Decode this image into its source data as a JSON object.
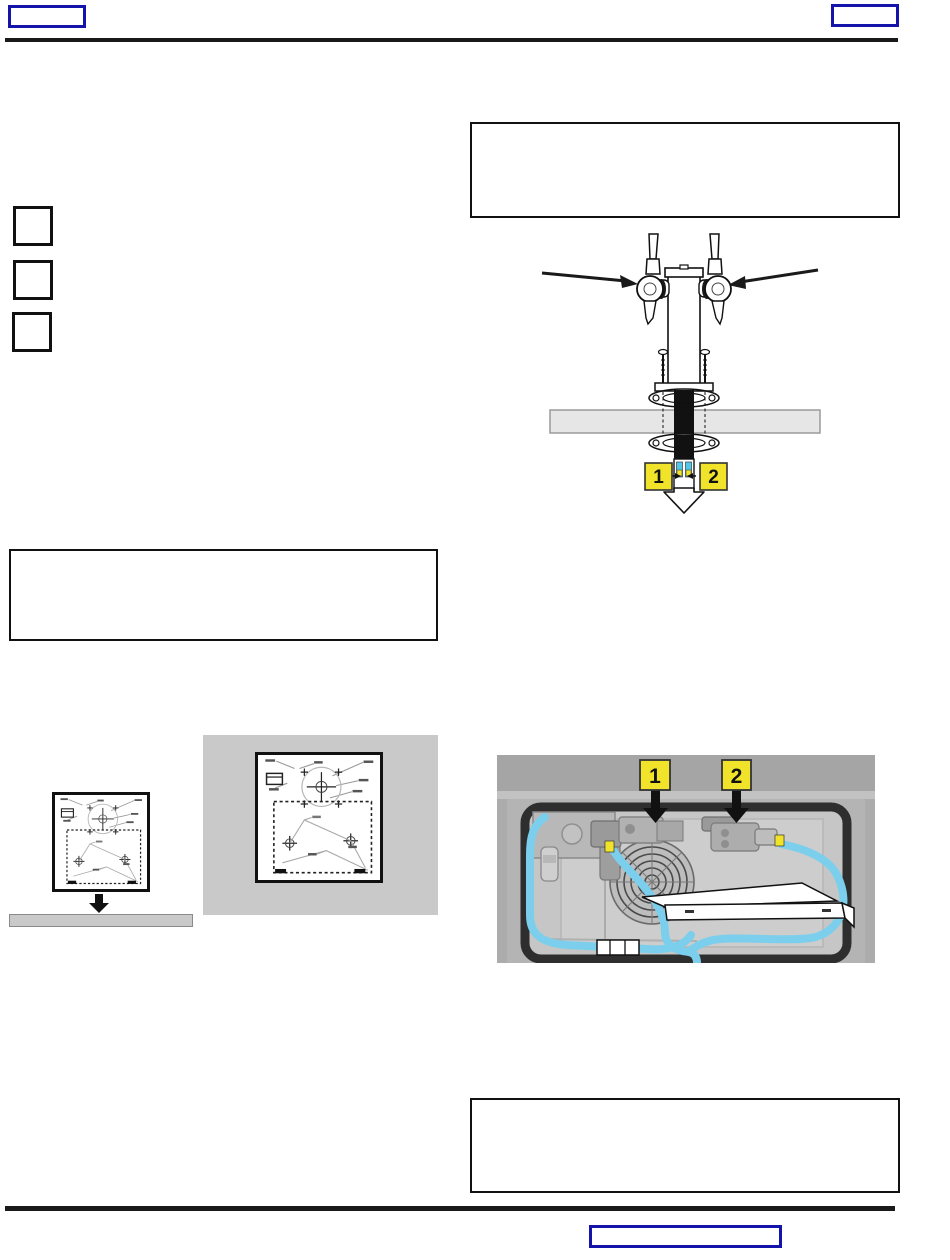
{
  "callouts": {
    "tower": [
      {
        "label": "1"
      },
      {
        "label": "2"
      }
    ],
    "cooler": [
      {
        "label": "1"
      },
      {
        "label": "2"
      }
    ]
  },
  "colors": {
    "accent_blue": "#1414AA",
    "callout_yellow": "#F0E32A",
    "tube_blue": "#7CCFEC",
    "tube_end_cyan": "#53C7E8",
    "rule_black": "#1a1a1a",
    "panel_gray": "#C9C9C9",
    "counter_gray": "#E6E6E6",
    "cooler_outer_gray": "#ACACAC",
    "gasket_dark": "#2E2E2E"
  }
}
